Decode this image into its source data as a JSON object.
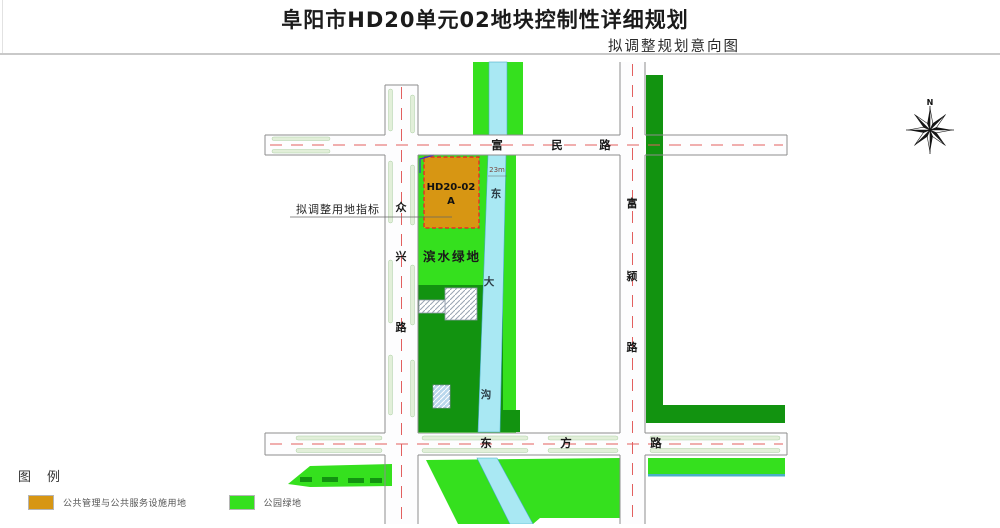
{
  "header": {
    "title": "阜阳市HD20单元02地块控制性详细规划",
    "subtitle": "拟调整规划意向图"
  },
  "map": {
    "roads": {
      "fumin": {
        "name": "富民路",
        "chars": [
          "富",
          "民",
          "路"
        ]
      },
      "dongfang": {
        "name": "东方路",
        "chars": [
          "东",
          "方",
          "路"
        ]
      },
      "zhongxing": {
        "name": "众兴路",
        "chars": [
          "众",
          "兴",
          "路"
        ]
      },
      "fuying": {
        "name": "富颍路",
        "chars": [
          "富",
          "颍",
          "路"
        ]
      }
    },
    "waterway": {
      "name": "东大沟",
      "chars": [
        "东",
        "大",
        "沟"
      ],
      "width_label": "23m"
    },
    "parcel": {
      "code": "HD20-02",
      "suffix": "A"
    },
    "annotation_label": "拟调整用地指标",
    "waterfront_green_label": "滨水绿地",
    "compass_north": "N"
  },
  "legend": {
    "title": "图例",
    "items": [
      {
        "label": "公共管理与公共服务设施用地",
        "color": "#d79613"
      },
      {
        "label": "公园绿地",
        "color": "#35e01e"
      }
    ]
  },
  "colors": {
    "bright_green": "#35e01e",
    "dark_green": "#129310",
    "water_cyan": "#a9e8f3",
    "water_edge": "#49aec6",
    "parcel_orange": "#d79613",
    "parcel_border_red": "#f01828",
    "parcel_edge_blue": "#4030c8",
    "road_fill": "#fdfdfe",
    "road_border": "#8d8d8d",
    "centerline_red": "#e25f5f",
    "verge_fill": "#e2efd9",
    "verge_border": "#abcfa3",
    "label_dark": "#1a1a1a",
    "leader_gray": "#666666"
  }
}
